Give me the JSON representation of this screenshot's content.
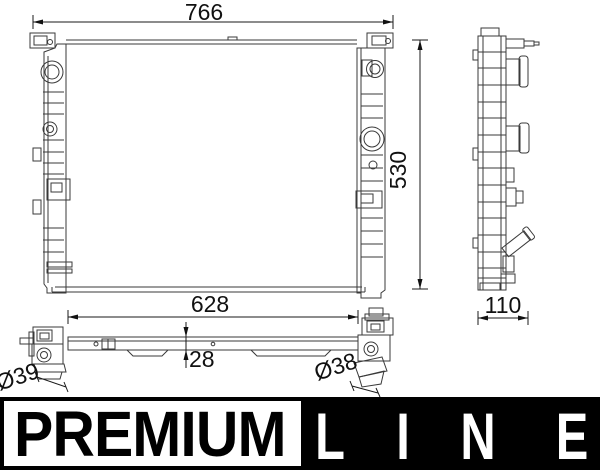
{
  "drawing": {
    "dim_width": "766",
    "dim_height": "530",
    "dim_depth": "110",
    "dim_lower_width": "628",
    "dim_bracket": "28",
    "dim_left_port": "Ø39",
    "dim_right_port": "Ø38"
  },
  "banner": {
    "premium": "PREMIUM",
    "line_letters": [
      "L",
      "I",
      "N",
      "E"
    ]
  },
  "colors": {
    "background": "#ffffff",
    "line_art": "#3a3a3a",
    "dimension_text": "#111111",
    "banner_background": "#000000",
    "premium_box_background": "#ffffff",
    "premium_text": "#000000",
    "line_text": "#ffffff"
  }
}
